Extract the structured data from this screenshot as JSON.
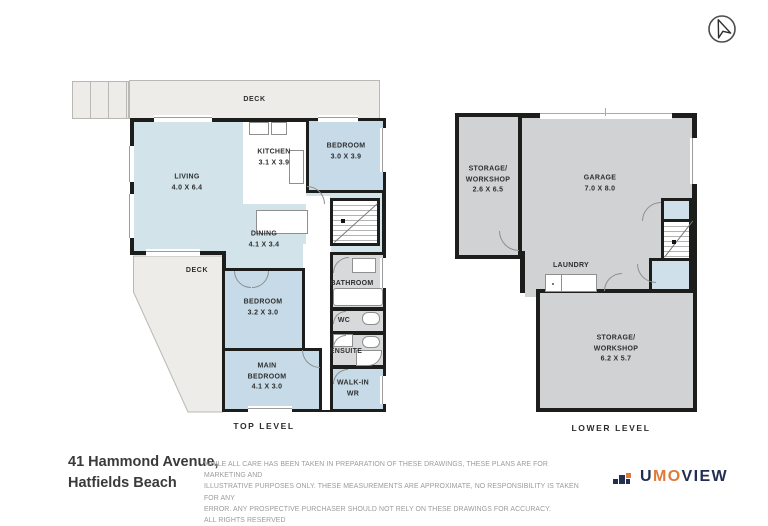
{
  "compass": {
    "icon": "north-arrow-compass-icon"
  },
  "colors": {
    "walls": "#1d1d1b",
    "room_blue": "#c6dbe7",
    "open_area_blue": "#d2e4ea",
    "room_gray": "#d1d2d4",
    "bath_gray": "#d8d9db",
    "deck_gray": "#edece8",
    "logo_navy": "#232f52",
    "logo_orange": "#e0793a"
  },
  "plans": {
    "top": {
      "title": "TOP LEVEL",
      "deck_top": "DECK",
      "deck_side": "DECK",
      "rooms": {
        "living": {
          "name": "LIVING",
          "dims": "4.0 X 6.4"
        },
        "kitchen": {
          "name": "KITCHEN",
          "dims": "3.1 X 3.9"
        },
        "bedroom1": {
          "name": "BEDROOM",
          "dims": "3.0 X 3.9"
        },
        "dining": {
          "name": "DINING",
          "dims": "4.1 X 3.4"
        },
        "bedroom2": {
          "name": "BEDROOM",
          "dims": "3.2 X 3.0"
        },
        "main_bedroom": {
          "name_line1": "MAIN",
          "name_line2": "BEDROOM",
          "dims": "4.1 X 3.0"
        },
        "bathroom": {
          "name": "BATHROOM"
        },
        "wc": {
          "name": "WC"
        },
        "ensuite": {
          "name": "ENSUITE"
        },
        "walk_in": {
          "name_line1": "WALK-IN",
          "name_line2": "WR"
        }
      }
    },
    "lower": {
      "title": "LOWER LEVEL",
      "rooms": {
        "storage_workshop_1": {
          "name_line1": "STORAGE/",
          "name_line2": "WORKSHOP",
          "dims": "2.6 X 6.5"
        },
        "garage": {
          "name": "GARAGE",
          "dims": "7.0 X 8.0"
        },
        "laundry": {
          "name": "LAUNDRY"
        },
        "storage_workshop_2": {
          "name_line1": "STORAGE/",
          "name_line2": "WORKSHOP",
          "dims": "6.2 X 5.7"
        }
      }
    }
  },
  "footer": {
    "address_line1": "41 Hammond Avenue,",
    "address_line2": "Hatfields Beach",
    "disclaimer_line1": "WHILE ALL CARE HAS BEEN TAKEN IN PREPARATION OF THESE DRAWINGS, THESE PLANS ARE FOR MARKETING AND",
    "disclaimer_line2": "ILLUSTRATIVE PURPOSES ONLY. THESE MEASUREMENTS ARE APPROXIMATE, NO RESPONSIBILITY IS TAKEN FOR ANY",
    "disclaimer_line3": "ERROR. ANY PROSPECTIVE PURCHASER SHOULD NOT RELY ON THESE DRAWINGS FOR ACCURACY.",
    "disclaimer_line4": "ALL RIGHTS RESERVED",
    "logo": {
      "mark_icon": "building-steps-logo-icon",
      "text_part1": "U",
      "text_part2": "MO",
      "text_part3": "VIEW"
    }
  }
}
